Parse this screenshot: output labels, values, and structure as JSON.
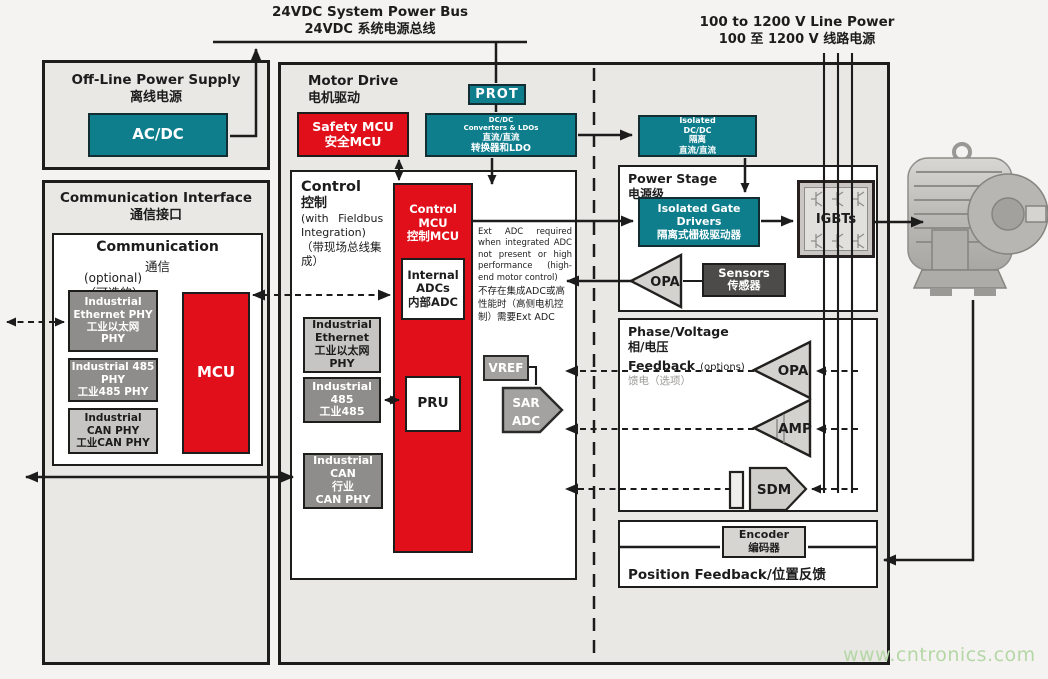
{
  "palette": {
    "teal": "#0e7e8d",
    "red": "#e10f1a",
    "dark_gray": "#8e8d8b",
    "light_gray": "#c6c5c3",
    "panel_fill": "#e9e8e5",
    "sensor_dark": "#4c4b49",
    "watermark_green": "#b5d7a6"
  },
  "top": {
    "bus_en": "24VDC System Power Bus",
    "bus_zh": "24VDC 系统电源总线",
    "line_power_en": "100 to 1200 V Line Power",
    "line_power_zh": "100 至 1200 V 线路电源"
  },
  "offline": {
    "title_en": "Off-Line Power Supply",
    "title_zh": "离线电源",
    "acdc": "AC/DC"
  },
  "comm_interface": {
    "title_en": "Communication Interface",
    "title_zh": "通信接口",
    "comm_title_en": "Communication",
    "comm_title_zh": "通信",
    "optional_en": "(optional)",
    "optional_zh": "（可选的）",
    "eth_phy": [
      "Industrial",
      "Ethernet PHY",
      "工业以太网",
      "PHY"
    ],
    "phy485": [
      "Industrial 485",
      "PHY",
      "工业485 PHY"
    ],
    "can_phy": [
      "Industrial",
      "CAN PHY",
      "工业CAN PHY"
    ],
    "mcu": "MCU"
  },
  "motor_drive": {
    "title_en": "Motor Drive",
    "title_zh": "电机驱动",
    "safety_mcu": [
      "Safety MCU",
      "安全MCU"
    ],
    "prot": "PROT",
    "dcdc": [
      "DC/DC",
      "Converters & LDOs",
      "直流/直流",
      "转换器和LDO"
    ],
    "iso_dcdc": [
      "Isolated",
      "DC/DC",
      "隔离",
      "直流/直流"
    ]
  },
  "control": {
    "title_en": "Control",
    "title_zh": "控制",
    "subtitle": [
      "(with Fieldbus",
      "Integration)",
      "（带现场总线集",
      "成）"
    ],
    "mcu": [
      "Control",
      "MCU",
      "控制MCU"
    ],
    "internal_adcs": [
      "Internal",
      "ADCs",
      "内部ADC"
    ],
    "pru": "PRU",
    "eth_phy": [
      "Industrial",
      "Ethernet",
      "工业以太网",
      "PHY"
    ],
    "phy485": [
      "Industrial",
      "485",
      "工业485"
    ],
    "can_phy": [
      "Industrial",
      "CAN",
      "行业",
      "CAN PHY"
    ],
    "vref": "VREF",
    "sar_adc": [
      "SAR",
      "ADC"
    ],
    "ext_adc_note_en": "Ext ADC required when integrated ADC not present or high performance (high-end motor control)",
    "ext_adc_note_zh": "不存在集成ADC或高性能时（高侧电机控制）需要Ext ADC"
  },
  "power_stage": {
    "title_en": "Power Stage",
    "title_zh": "电源级",
    "gate_drivers": [
      "Isolated Gate Drivers",
      "隔离式栅极驱动器"
    ],
    "igbts": "IGBTs",
    "opa": "OPA",
    "sensors": [
      "Sensors",
      "传感器"
    ]
  },
  "phase_feedback": {
    "title_en": "Phase/Voltage",
    "title_zh": "相/电压",
    "feedback": "Feedback",
    "options": "(options)",
    "options_zh": "馈电（选项）",
    "opa": "OPA",
    "amp": "AMP",
    "sdm": "SDM"
  },
  "position_feedback": {
    "encoder": [
      "Encoder",
      "编码器"
    ],
    "label": "Position Feedback/位置反馈"
  },
  "watermark": "www.cntronics.com"
}
